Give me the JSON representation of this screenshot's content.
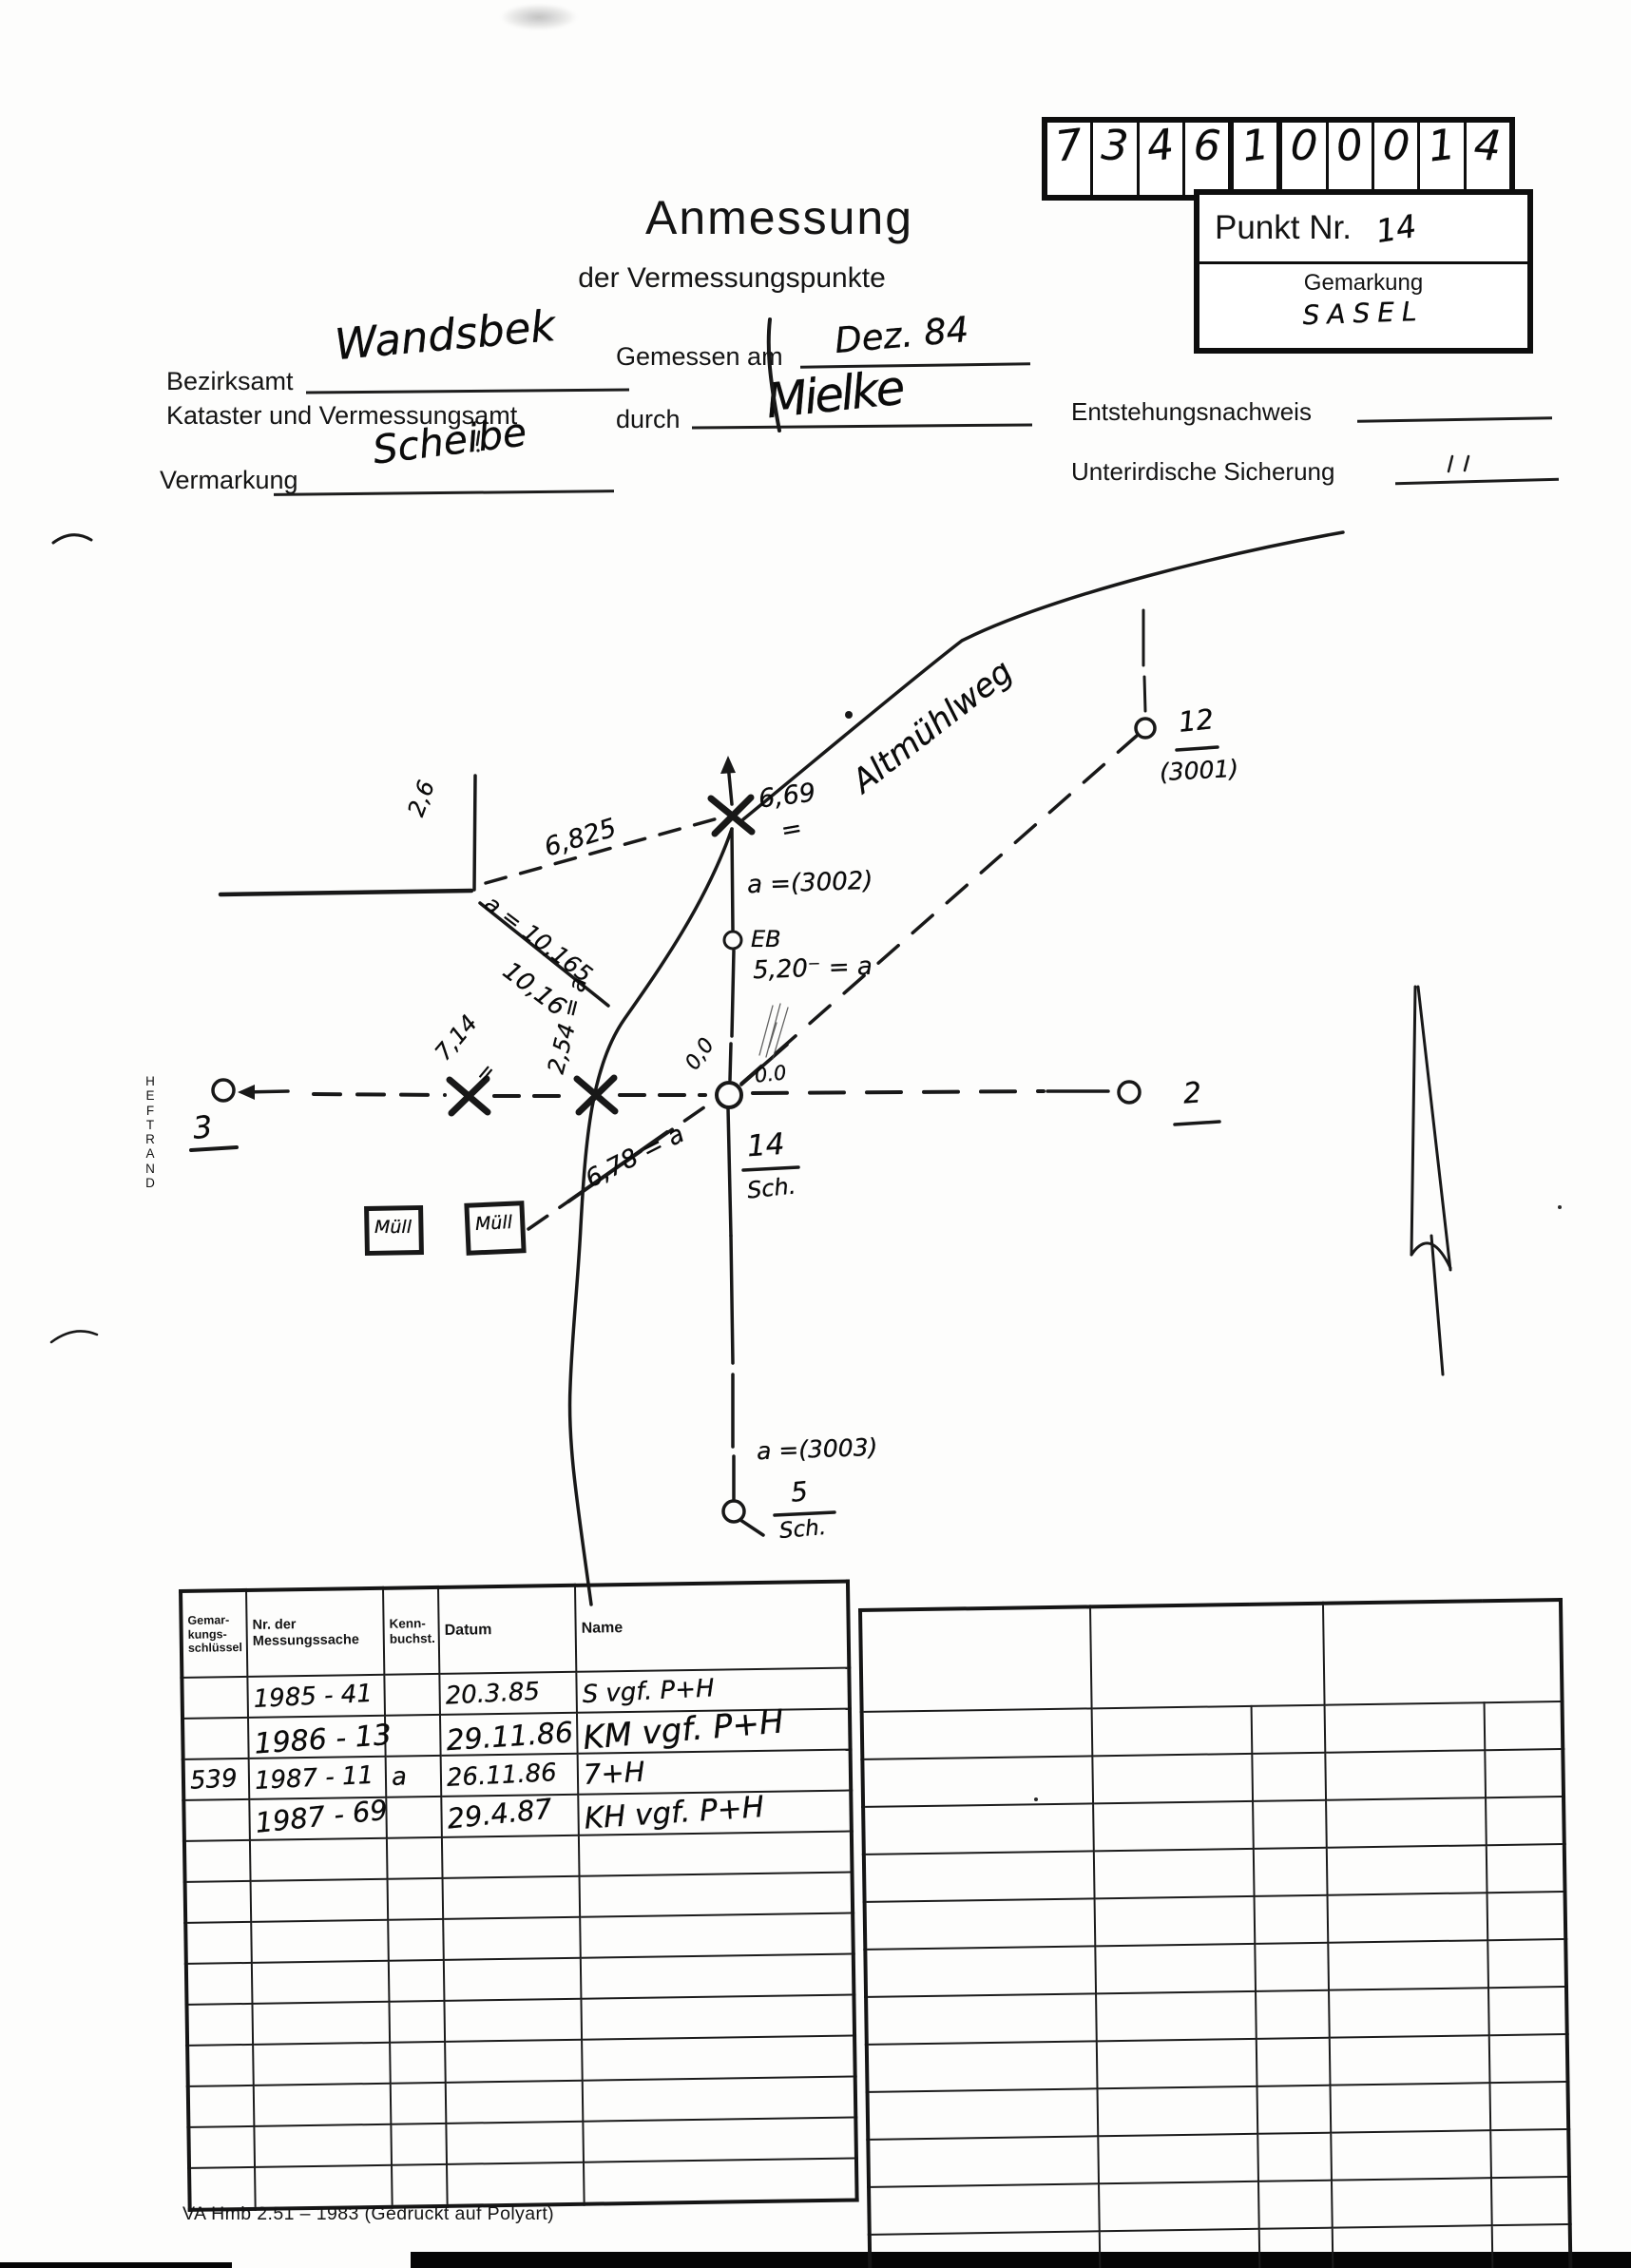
{
  "header": {
    "title": "Anmessung",
    "subtitle": "der Vermessungspunkte",
    "code_digits": [
      "7",
      "3",
      "4",
      "6",
      "1",
      "0",
      "0",
      "0",
      "1",
      "4"
    ],
    "punkt_nr_label": "Punkt Nr.",
    "punkt_nr_value": "14",
    "gemarkung_label": "Gemarkung",
    "gemarkung_value": "SASEL"
  },
  "form": {
    "bezirksamt_label": "Bezirksamt",
    "bezirksamt_value": "Wandsbek",
    "kataster_label": "Kataster und Vermessungsamt",
    "gemessen_am_label": "Gemessen am",
    "gemessen_am_value": "Dez. 84",
    "durch_label": "durch",
    "durch_value": "Mielke",
    "vermarkung_label": "Vermarkung",
    "vermarkung_value": "Scheibe",
    "entstehungsnachweis_label": "Entstehungsnachweis",
    "unterirdische_sicherung_label": "Unterirdische Sicherung"
  },
  "sketch": {
    "street_name": "Altmühlweg",
    "heftrand": "H\nE\nF\nT\nR\nA\nN\nD",
    "labels": {
      "corner_offset": "2,6",
      "d6825": "6,825",
      "d669": "6,69",
      "d669_eq": "=",
      "d10165": "a = 10,165",
      "d1016": "10,16",
      "aux3002": "a =(3002)",
      "eb": "EB",
      "d520": "5,20⁻ = a",
      "d714": "7,14",
      "d714_eq": "=",
      "d254": "2,54 = a",
      "d678": "6,78 = a",
      "zero_rot": "0,0",
      "zero": "0.0",
      "p14": "14",
      "p14_sub": "Sch.",
      "p3": "3",
      "p2": "2",
      "p12": "12",
      "p12_alt": "(3001)",
      "p5": "5",
      "p5_sub": "Sch.",
      "aux3003": "a =(3003)",
      "muell": "Müll"
    }
  },
  "table_left": {
    "headers": [
      "Gemar-\nkungs-\nschlüssel",
      "Nr. der\nMessungssache",
      "Kenn-\nbuchst.",
      "Datum",
      "Name"
    ],
    "entries": [
      {
        "gemarkung": "",
        "nr": "1985 - 41",
        "kenn": "",
        "datum": "20.3.85",
        "name": "S vgf.  P+H"
      },
      {
        "gemarkung": "",
        "nr": "1986 - 13",
        "kenn": "",
        "datum": "29.11.86",
        "name": "KM vgf.  P+H"
      },
      {
        "gemarkung": "539",
        "nr": "1987 - 11",
        "kenn": "a",
        "datum": "26.11.86",
        "name": "7+H"
      },
      {
        "gemarkung": "",
        "nr": "1987 - 69",
        "kenn": "",
        "datum": "29.4.87",
        "name": "KH vgf.  P+H"
      }
    ],
    "empty_rows": 9
  },
  "table_right": {
    "rows": 12
  },
  "footer": "VA Hmb 2.51 – 1983 (Gedruckt auf Polyart)"
}
